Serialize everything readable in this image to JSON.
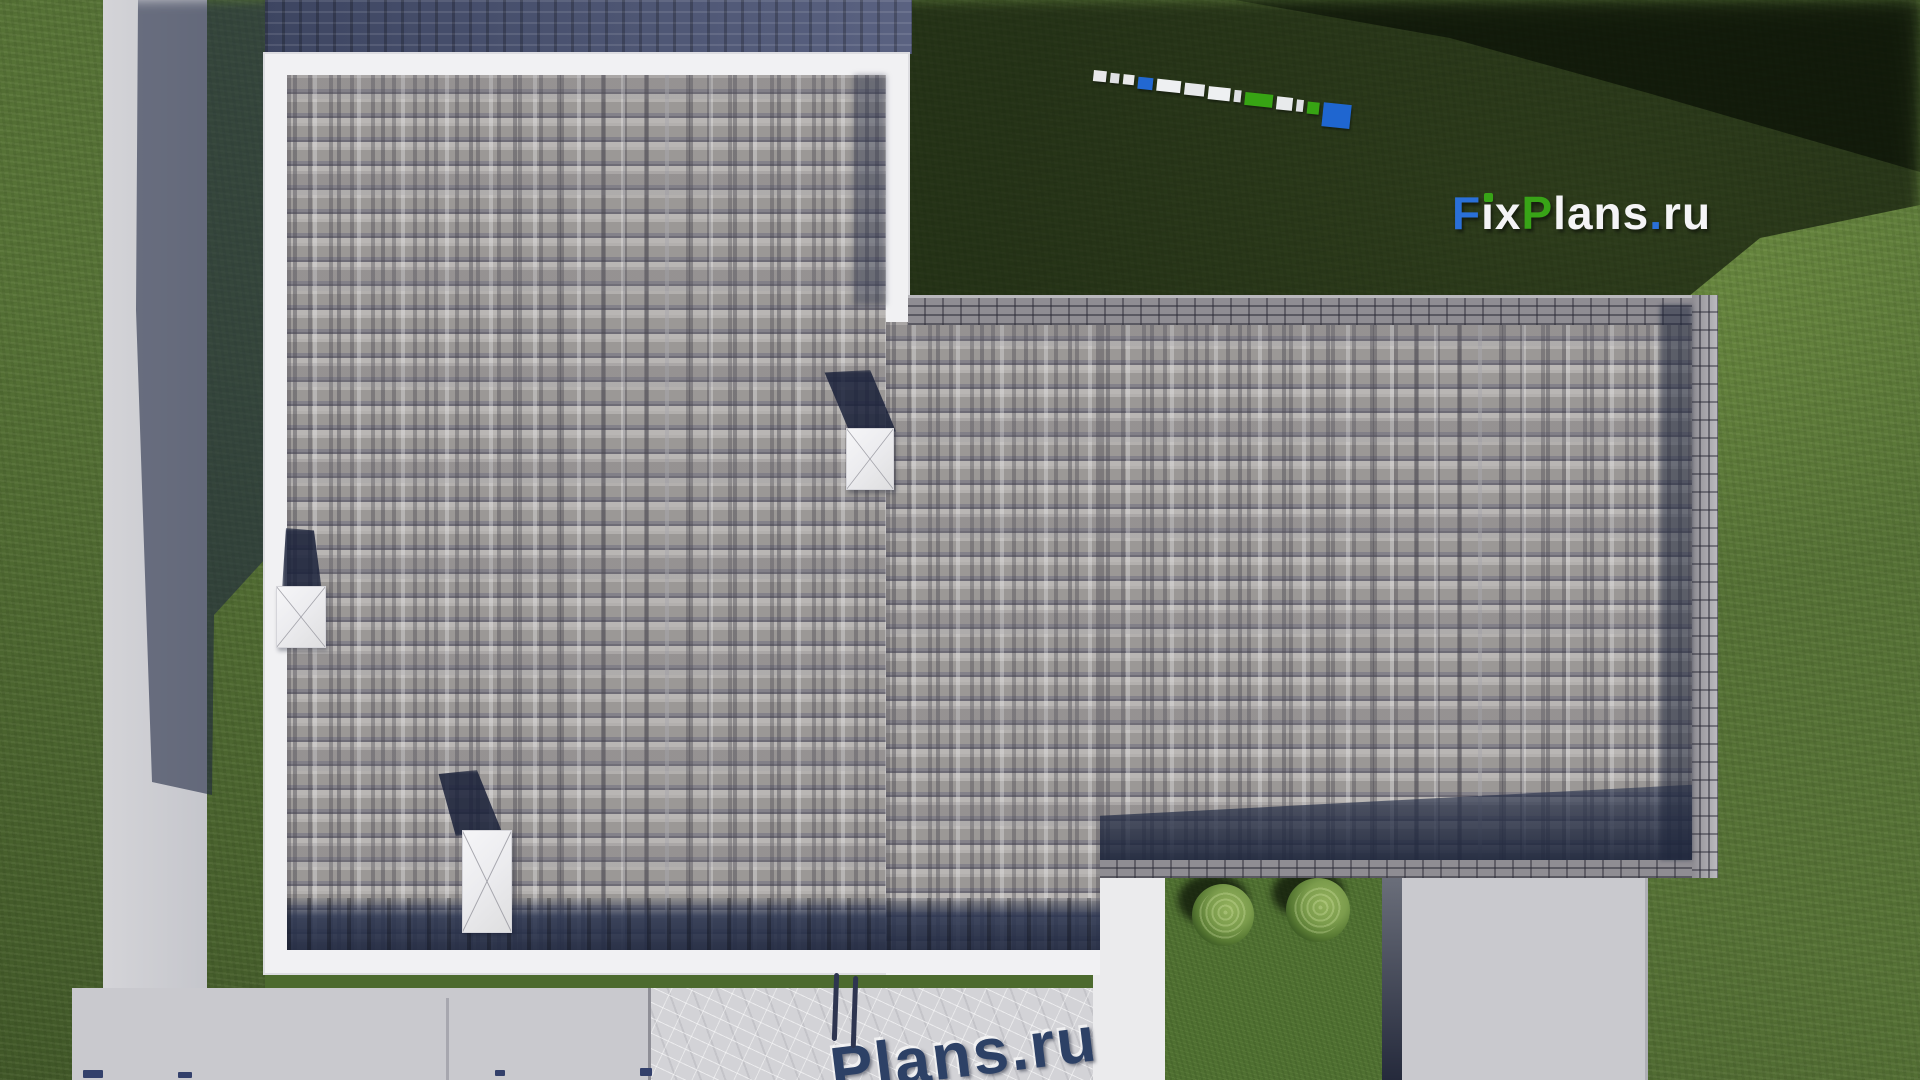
{
  "site": {
    "logo_text": "FixPlans.ru",
    "logo_letters": [
      {
        "ch": "F",
        "color": "#2a70d8"
      },
      {
        "ch": "i",
        "color": "#f4f4f6"
      },
      {
        "ch": "x",
        "color": "#f4f4f6"
      },
      {
        "ch": "P",
        "color": "#38a417"
      },
      {
        "ch": "l",
        "color": "#f4f4f6"
      },
      {
        "ch": "a",
        "color": "#f4f4f6"
      },
      {
        "ch": "n",
        "color": "#f4f4f6"
      },
      {
        "ch": "s",
        "color": "#f4f4f6"
      },
      {
        "ch": ".",
        "color": "#2a70d8"
      },
      {
        "ch": "r",
        "color": "#f4f4f6"
      },
      {
        "ch": "u",
        "color": "#f4f4f6"
      }
    ],
    "logo_dot_color": "#38a417"
  },
  "watermark_bottom": {
    "text": "Plans.ru",
    "color": "#2d4166"
  },
  "ruler": {
    "blocks": [
      {
        "w": 13,
        "h": 11,
        "c": "#e8e8ea",
        "up": 0
      },
      {
        "w": 9,
        "h": 10,
        "c": "#dfe0e4",
        "up": 1
      },
      {
        "w": 11,
        "h": 10,
        "c": "#e8e8ea",
        "up": 1
      },
      {
        "w": 15,
        "h": 12,
        "c": "#2268d2",
        "up": 2
      },
      {
        "w": 24,
        "h": 12,
        "c": "#eef0f2",
        "up": 2
      },
      {
        "w": 20,
        "h": 12,
        "c": "#e6e8ea",
        "up": 3
      },
      {
        "w": 22,
        "h": 13,
        "c": "#eef0f2",
        "up": 4
      },
      {
        "w": 7,
        "h": 12,
        "c": "#dfe0e4",
        "up": 5
      },
      {
        "w": 28,
        "h": 13,
        "c": "#37a414",
        "up": 6
      },
      {
        "w": 16,
        "h": 13,
        "c": "#e8eaec",
        "up": 7
      },
      {
        "w": 7,
        "h": 12,
        "c": "#dfe0e4",
        "up": 8
      },
      {
        "w": 12,
        "h": 12,
        "c": "#37a414",
        "up": 9
      },
      {
        "w": 28,
        "h": 24,
        "c": "#1f66d0",
        "up": 8
      }
    ]
  },
  "bottom_marks": [
    {
      "x": 83,
      "y": 1070,
      "w": 20,
      "h": 8
    },
    {
      "x": 178,
      "y": 1072,
      "w": 14,
      "h": 6
    },
    {
      "x": 495,
      "y": 1070,
      "w": 10,
      "h": 6
    },
    {
      "x": 640,
      "y": 1068,
      "w": 12,
      "h": 8
    }
  ],
  "palette": {
    "c-grass": "#567236",
    "c-grass-hi": "#6e8e42",
    "c-grass-lo": "#46602a",
    "c-shingle": "#a6a3a1",
    "c-shingle-dark": "#6e6c76",
    "c-fascia": "#f1f1f3",
    "c-navy": "#4e5876",
    "c-eave": "#2a3450",
    "c-brick": "#8f8d93",
    "c-brick-light": "#b7b6bb",
    "c-walk": "#d0d0d5",
    "c-concrete": "#c9c9ce",
    "c-terrace": "#d3d3d7",
    "c-walk-bright": "#ebebed",
    "c-lawn": "#4f7031",
    "c-seam-dark": "#252a3c",
    "c-blue": "#2269d3",
    "c-green": "#38a417",
    "c-wm": "#2d4166"
  }
}
